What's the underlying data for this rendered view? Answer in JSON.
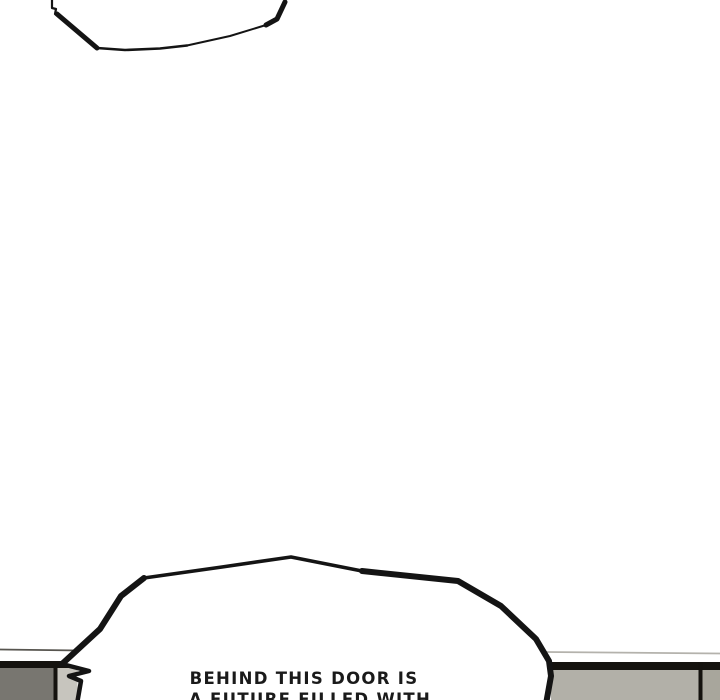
{
  "page": {
    "kind": "comic-panel",
    "background": "#ffffff"
  },
  "colors": {
    "ink": "#141414",
    "bg_wall_line_left": "#57554f",
    "bg_wall_line_right": "#b4b2ac",
    "wall_top_band": "#15130f",
    "left_wall_fill": "#787670",
    "left_wall_divider": "#14120e",
    "left_wall_edge_fill": "#c7c5be",
    "right_wall_fill": "#b2b0a8",
    "right_wall_divider": "#14120e",
    "right_wall_far_fill": "#a8a69c",
    "bubble_fill": "#ffffff",
    "text_color": "#1a1a1a"
  },
  "bubbles": {
    "bottom": {
      "line1": "BEHIND THIS DOOR IS",
      "line2": "A FUTURE FILLED WITH"
    }
  }
}
